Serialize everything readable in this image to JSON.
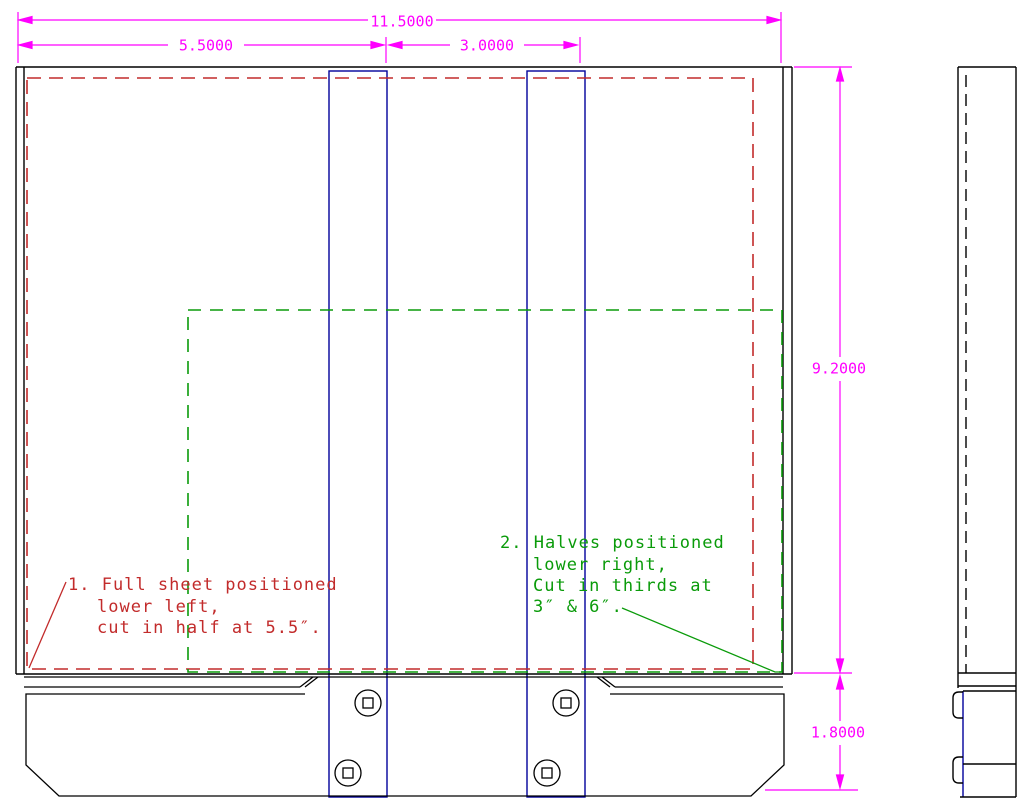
{
  "dimensions": {
    "total_width": "11.5000",
    "half_width": "5.5000",
    "third_width": "3.0000",
    "panel_height": "9.2000",
    "base_height": "1.8000"
  },
  "notes": {
    "note1": {
      "color": "#C22B2B",
      "lines": [
        "1. Full sheet positioned",
        "lower left,",
        "cut in half at 5.5″."
      ]
    },
    "note2": {
      "color": "#0A9B0A",
      "lines": [
        "2. Halves positioned",
        "lower right,",
        "Cut in thirds at",
        "3″ & 6″."
      ]
    }
  },
  "colors": {
    "dimension_lines": "#FF00FF",
    "cut_guides": "#00009B",
    "full_sheet_outline": "#C22B2B",
    "halves_outline": "#0A9B0A",
    "geometry": "#000000",
    "background": "#FFFFFF"
  }
}
